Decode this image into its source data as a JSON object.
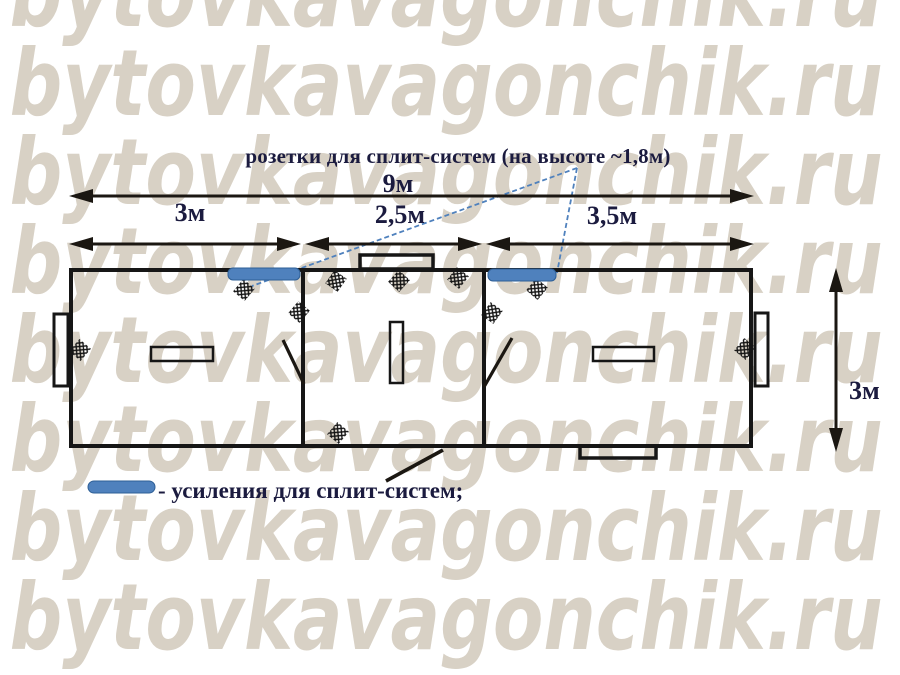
{
  "watermark": {
    "text": "bytovkavagonchik.ru",
    "color": "#d8d1c5"
  },
  "annotation": {
    "sockets_note": "розетки для сплит-систем (на высоте ~1,8м)"
  },
  "dimensions": {
    "total_length": "9м",
    "room_left": "3м",
    "room_middle": "2,5м",
    "room_right": "3,5м",
    "depth": "3м"
  },
  "legend": {
    "text": "- усиления для сплит-систем;"
  },
  "colors": {
    "reinforcement_blue": "#4f81bd",
    "reinforcement_edge": "#2e5f96",
    "pointer_blue": "#4f81bd",
    "line_black": "#1b1712",
    "text_navy": "#1b1b3f",
    "watermark_beige": "#d8d1c5"
  }
}
